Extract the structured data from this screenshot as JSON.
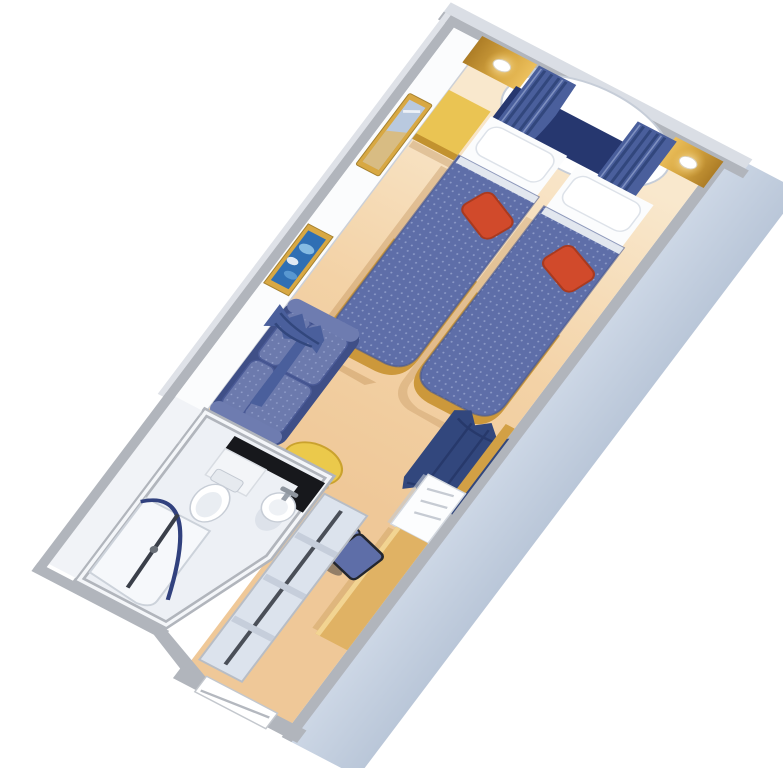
{
  "scene": {
    "description": "isometric-cutaway-floorplan-cruise-ship-stateroom",
    "rooms": {
      "bedroom": [
        "picture-window-oval",
        "window-curtains",
        "wood-panels-with-sconces",
        "navy-headboard",
        "twin-bed-left",
        "twin-bed-right",
        "white-pillows",
        "red-accent-pillows",
        "nightstand",
        "wall-mirror",
        "framed-seascape-picture",
        "loveseat-sofa",
        "round-coffee-table",
        "room-divider-curtains",
        "desk-with-chair",
        "white-cabinet"
      ],
      "bathroom": [
        "black-vanity-counter",
        "vanity-cabinet",
        "pedestal-sink",
        "toilet",
        "shower-with-curved-rod",
        "towel-bars"
      ],
      "entry": [
        "wardrobe-closet-with-rod",
        "entry-door"
      ]
    }
  },
  "colors": {
    "background": "#ffffff",
    "carpet": "#f1cc9f",
    "carpet_light": "#f9e8cd",
    "bathroom_floor": "#edf0f5",
    "wall_white": "#fbfcfd",
    "wall_cap": "#b1b5bc",
    "wall_outer": "#dadee5",
    "hull": "#c8d3e2",
    "window_wall": "#c3cedd",
    "window_white": "#ffffff",
    "gold": "#d8a843",
    "gold_dark": "#ad7d26",
    "gold_light": "#ecc05d",
    "headboard_navy": "#26376f",
    "curtain": "#4a5f9c",
    "curtain_dark": "#32477d",
    "curtain_light": "#7e90c0",
    "bedspread": "#5e6ea8",
    "bedspread_dot": "#8d9bc8",
    "bed_wood": "#cc983b",
    "sheet_white": "#fbfcfd",
    "pillow_white": "#ffffff",
    "red_pillow": "#d14a2b",
    "sofa_frame": "#3f4f87",
    "sofa_cushion": "#6c7aad",
    "table_yellow": "#ebc94b",
    "table_edge": "#caa22e",
    "desk_wood": "#e0b264",
    "desk_highlight": "#f2d492",
    "cabinet_white": "#fcfdfe",
    "counter_black": "#17181c",
    "fixture_white": "#ffffff",
    "fixture_stroke": "#c7cdd6",
    "metal_gray": "#9aa1ab",
    "rod_navy": "#31417e",
    "rod_dark": "#4a4f58",
    "closet_panel": "#dce3ed",
    "closet_divider": "#c6cedb",
    "nightstand_yellow": "#eac453",
    "art_blue": "#2f6fb4",
    "art_light": "#8fc3e8",
    "mirror_glass": "#b9c9df",
    "mirror_tan": "#dcba79",
    "shadow": "#b07a3e"
  }
}
